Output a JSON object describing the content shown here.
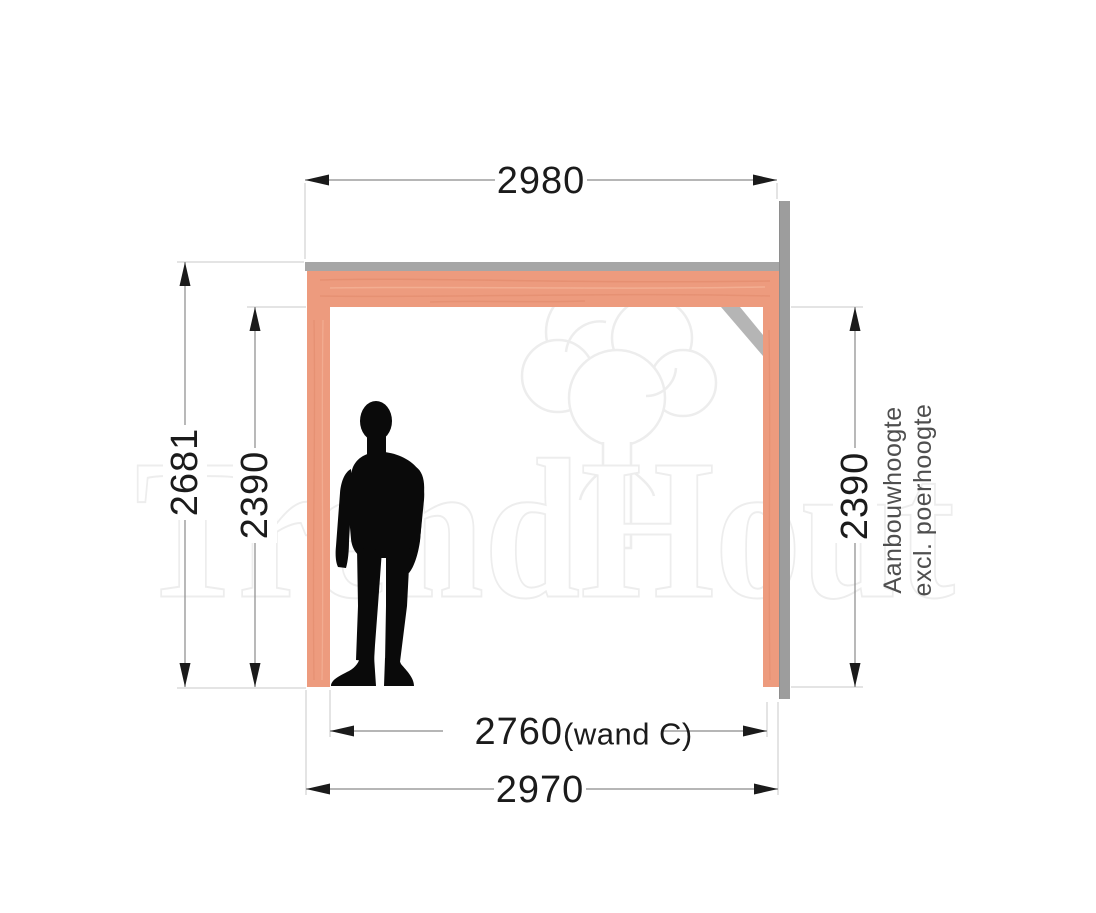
{
  "watermark": {
    "brand": "TrendHout"
  },
  "dimensions": {
    "top_width": "2980",
    "left_total_height": "2681",
    "left_clear_height": "2390",
    "right_clear_height": "2390",
    "bottom_wall_width_value": "2760",
    "bottom_wall_width_suffix": "(wand C)",
    "bottom_total_width": "2970"
  },
  "notes": {
    "right_line1": "Aanbouwhoogte",
    "right_line2": "excl. poerhoogte"
  },
  "colors": {
    "wood": "#ed9b7e",
    "wood_grain_dark": "#dd8263",
    "wood_grain_light": "#f7bda3",
    "top_plate_gray": "#a6a6a6",
    "wall_profile_gray": "#9d9d9d",
    "brace_gray": "#b5b5b5",
    "dimension_line": "#8a8a8a",
    "extension_line": "#c8c8c8",
    "dimension_text": "#1b1b1b",
    "note_text": "#4f4f4f",
    "figure_black": "#0a0a0a",
    "watermark_stroke": "#ededed"
  }
}
